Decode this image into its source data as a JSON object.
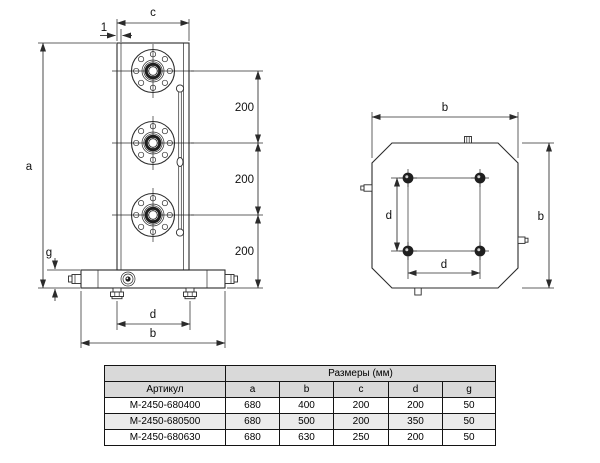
{
  "drawing": {
    "front_view": {
      "labels": {
        "c": "c",
        "wall": "1",
        "a": "a",
        "g": "g",
        "d": "d",
        "b": "b",
        "spacing": "200"
      }
    },
    "top_view": {
      "labels": {
        "b": "b",
        "d": "d"
      }
    }
  },
  "table": {
    "size_header": "Размеры (мм)",
    "article_header": "Артикул",
    "columns": [
      "a",
      "b",
      "c",
      "d",
      "g"
    ],
    "rows": [
      {
        "article": "M-2450-680400",
        "a": "680",
        "b": "400",
        "c": "200",
        "d": "200",
        "g": "50"
      },
      {
        "article": "M-2450-680500",
        "a": "680",
        "b": "500",
        "c": "200",
        "d": "350",
        "g": "50"
      },
      {
        "article": "M-2450-680630",
        "a": "680",
        "b": "630",
        "c": "250",
        "d": "200",
        "g": "50"
      }
    ]
  },
  "colors": {
    "background": "#ffffff",
    "line": "#2b2b2b",
    "table_header_bg": "#d9d9d9",
    "table_alt_row_bg": "#ebebeb"
  }
}
